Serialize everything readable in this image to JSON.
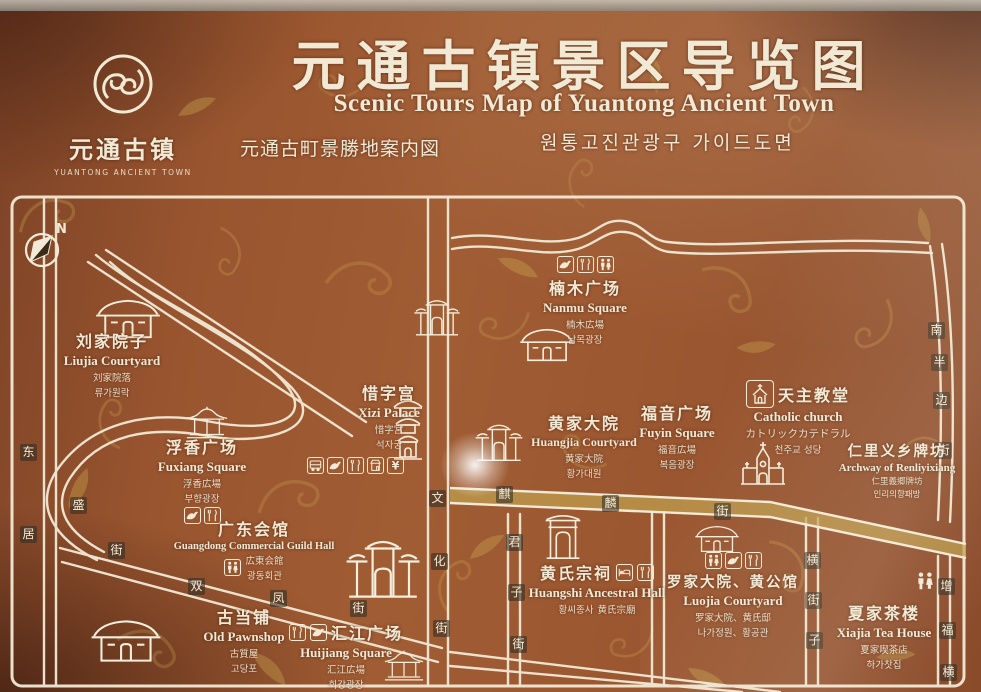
{
  "colors": {
    "background": "#99552F",
    "pattern_gold": "#C9A44E",
    "text_cream": "#F2E9D4",
    "road_line": "#F2EAD6",
    "road_gold_fill": "#BFA04E",
    "plate_dark": "#322C22"
  },
  "logo": {
    "name_zh": "元通古镇",
    "name_en": "YUANTONG ANCIENT TOWN"
  },
  "header": {
    "title_zh": "元通古镇景区导览图",
    "title_en": "Scenic Tours Map of Yuantong Ancient Town",
    "title_ja": "元通古町景勝地案内図",
    "title_ko": "원통고진관광구 가이드도면"
  },
  "compass": {
    "label": "N"
  },
  "streets": {
    "dongsheng": {
      "name": "东盛街",
      "chars": [
        "东",
        "盛",
        "街"
      ]
    },
    "shuangfeng": {
      "name": "双凤街",
      "chars": [
        "双",
        "凤",
        "街"
      ]
    },
    "wenhua": {
      "name": "文化街",
      "chars": [
        "文",
        "化",
        "街"
      ]
    },
    "qilin": {
      "name": "麒麟街",
      "chars": [
        "麒",
        "麟",
        "街"
      ]
    },
    "junzi": {
      "name": "君子街",
      "chars": [
        "君",
        "子",
        "街"
      ]
    },
    "nanbanbian": {
      "name": "南半边街",
      "chars": [
        "南",
        "半",
        "边",
        "街"
      ]
    },
    "hengjiezi": {
      "name": "横街子",
      "chars": [
        "横",
        "街",
        "子"
      ]
    },
    "zengfu": {
      "name": "增福横街",
      "chars": [
        "增",
        "福",
        "横"
      ]
    },
    "ju": {
      "name": "居",
      "chars": [
        "居"
      ]
    }
  },
  "pois": [
    {
      "id": "liujia",
      "zh": "刘家院子",
      "en": "Liujia Courtyard",
      "ja": "刘家院落",
      "ko": "류가원락",
      "icons": []
    },
    {
      "id": "xizi",
      "zh": "惜字宫",
      "en": "Xizi Palace",
      "ja": "惜字宮",
      "ko": "석자궁",
      "icons": [
        "bus",
        "scenic-bird",
        "restaurant",
        "shop",
        "currency-yuan"
      ]
    },
    {
      "id": "fuxiang",
      "zh": "浮香广场",
      "en": "Fuxiang Square",
      "ja": "浮香広場",
      "ko": "부향광장",
      "icons": [
        "scenic-bird",
        "restaurant"
      ]
    },
    {
      "id": "guangdong",
      "zh": "广东会馆",
      "en": "Guangdong Commercial Guild Hall",
      "ja": "広東会館",
      "ko": "광동회관",
      "icons": [
        "restroom"
      ]
    },
    {
      "id": "pawnshop",
      "zh": "古当铺",
      "en": "Old Pawnshop",
      "ja": "古質屋",
      "ko": "고당포",
      "icons": []
    },
    {
      "id": "huijiang",
      "zh": "汇江广场",
      "en": "Huijiang Square",
      "ja": "汇江広場",
      "ko": "회강광장",
      "icons": [
        "restaurant",
        "scenic-bird"
      ]
    },
    {
      "id": "nanmu",
      "zh": "楠木广场",
      "en": "Nanmu Square",
      "ja": "楠木広場",
      "ko": "남목광장",
      "icons": [
        "scenic-bird",
        "restaurant",
        "restroom"
      ]
    },
    {
      "id": "huangjia",
      "zh": "黄家大院",
      "en": "Huangjia Courtyard",
      "ja": "黄家大院",
      "ko": "황가대원",
      "icons": []
    },
    {
      "id": "fuyin",
      "zh": "福音广场",
      "en": "Fuyin Square",
      "ja": "福音広場",
      "ko": "복음광장",
      "icons": []
    },
    {
      "id": "catholic",
      "zh": "天主教堂",
      "en": "Catholic church",
      "ja": "カトリックカテドラル",
      "ko": "천주교 성당",
      "icons": [
        "church"
      ]
    },
    {
      "id": "renliyixiang",
      "zh": "仁里义乡牌坊",
      "en": "Archway of Renliyixiang",
      "ja": "仁里義郷牌坊",
      "ko": "인리의향패방",
      "icons": []
    },
    {
      "id": "huangshi",
      "zh": "黄氏宗祠",
      "en": "Huangshi Ancestral Hall",
      "ja": "黄氏宗廟",
      "ko": "황씨종사",
      "icons": [
        "bed",
        "restaurant"
      ]
    },
    {
      "id": "luojia",
      "zh": "罗家大院、黄公馆",
      "en": "Luojia Courtyard",
      "ja": "罗家大院、黄氏邸",
      "ko": "나가정원、황공관",
      "icons": [
        "restroom",
        "scenic-bird",
        "restaurant"
      ]
    },
    {
      "id": "xiajia",
      "zh": "夏家茶楼",
      "en": "Xiajia Tea House",
      "ja": "夏家喫茶店",
      "ko": "하가찻집",
      "icons": [
        "restroom"
      ]
    }
  ]
}
